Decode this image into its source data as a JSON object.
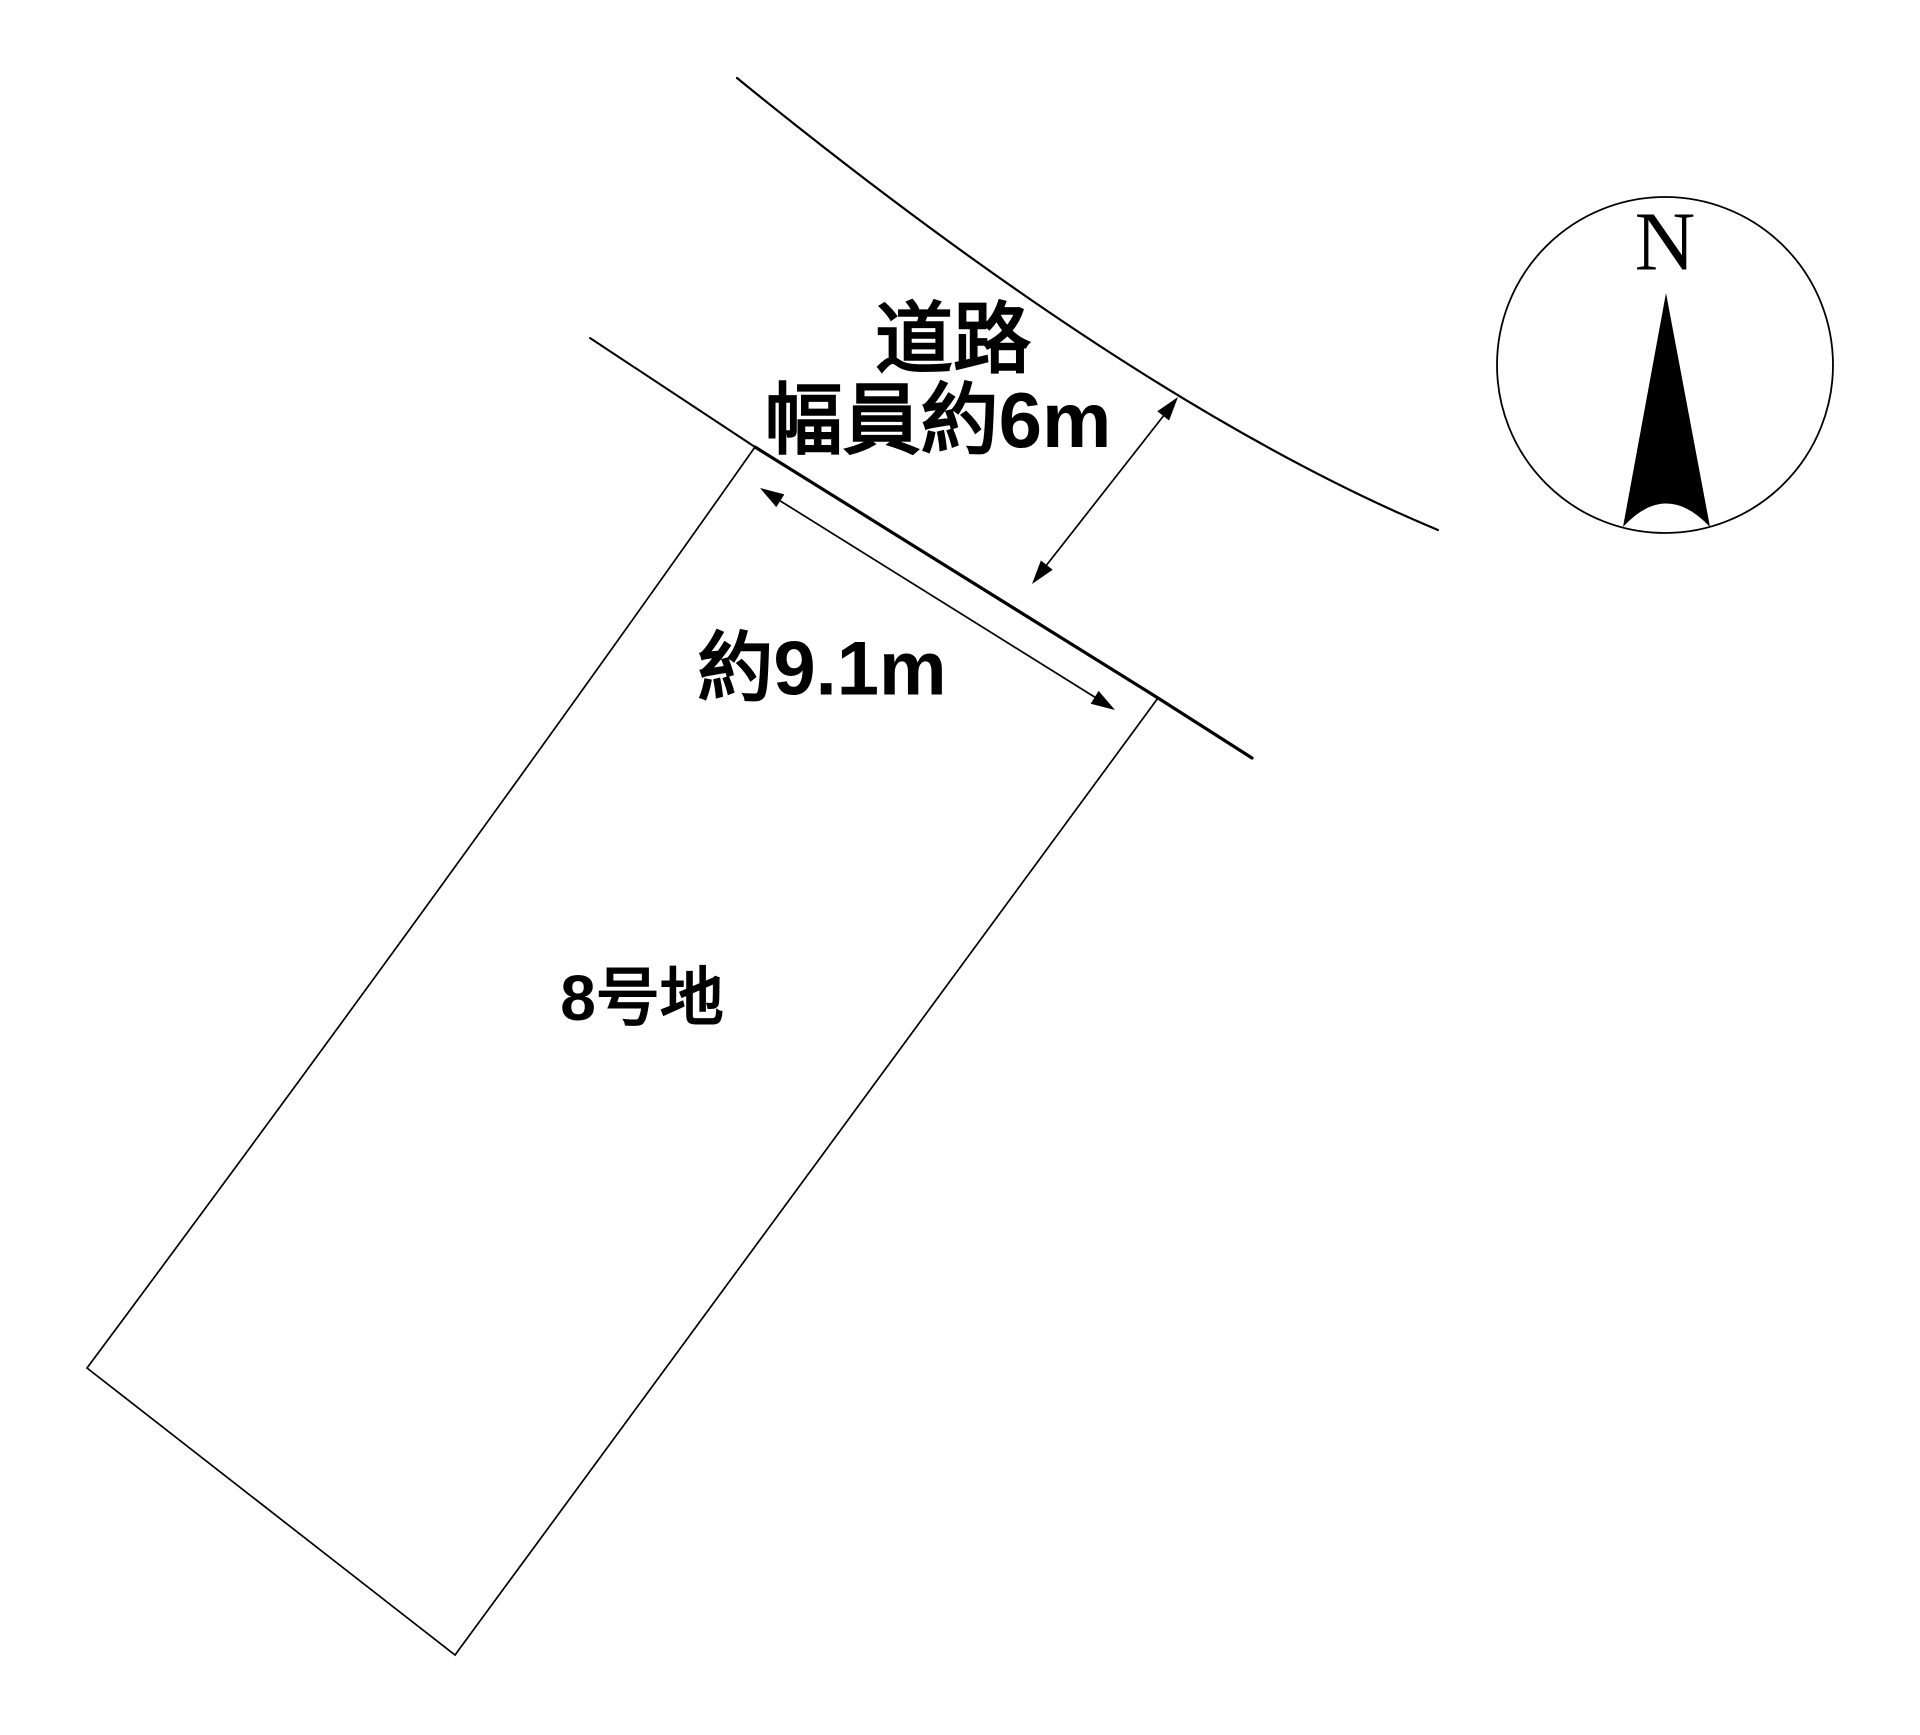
{
  "colors": {
    "background": "#ffffff",
    "ink": "#000000"
  },
  "labels": {
    "road_line1": "道路",
    "road_line2": "幅員約6m",
    "frontage_dimension": "約9.1m",
    "parcel": "8号地",
    "north": "N"
  }
}
